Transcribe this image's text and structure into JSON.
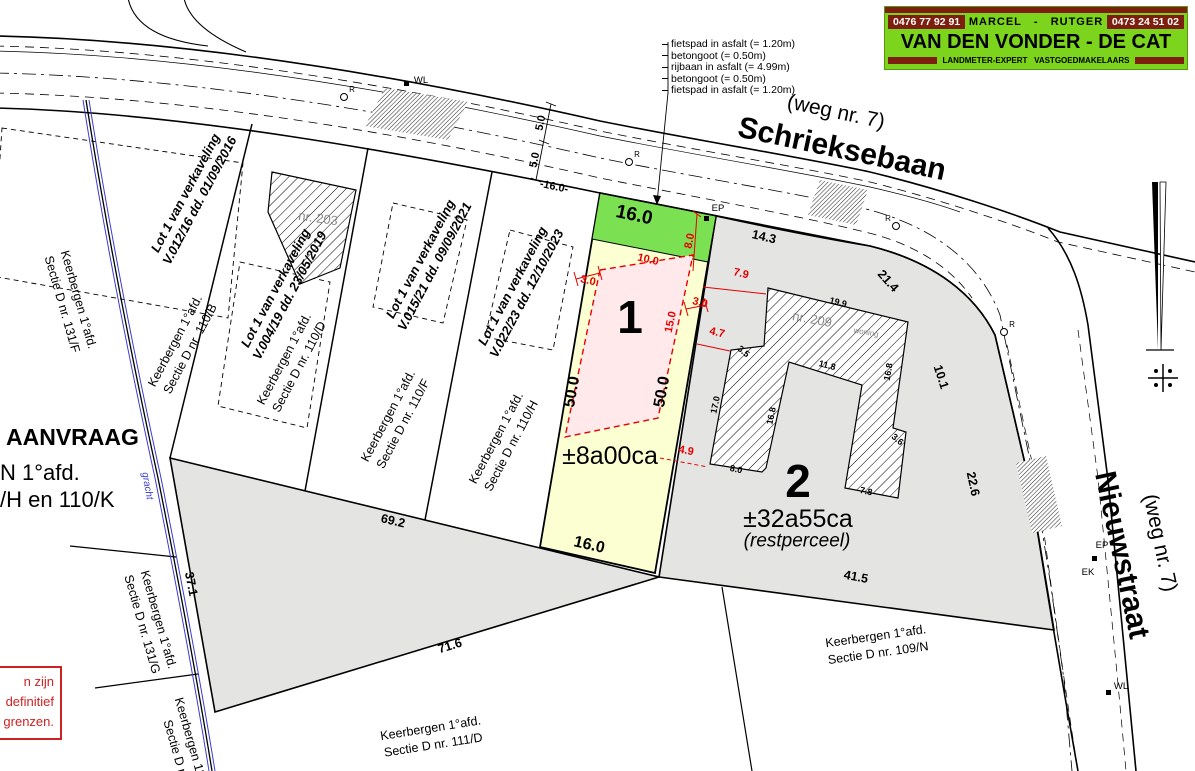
{
  "colors": {
    "background": "#ffffff",
    "parcel_gray": "#e4e4e2",
    "lot1_yellow": "#fcffd2",
    "lot1_green_strip": "#7ce053",
    "lot1_pink_zone": "#ffe9eb",
    "dimension_red": "#e60000",
    "logo_green": "#7cd41d",
    "logo_maroon": "#7d1e0e",
    "gracht_blue": "#3b3bd1",
    "warning_red": "#cc2222"
  },
  "logo": {
    "phone_left": "0476 77 92 91",
    "names": "MARCEL   -   RUTGER",
    "phone_right": "0473 24 51 02",
    "title": "VAN DEN VONDER - DE CAT",
    "subtitle": "LANDMETER-EXPERT   VASTGOEDMAKELAARS"
  },
  "road_legend": {
    "items": [
      "fietspad in asfalt (= 1.20m)",
      "betongoot (= 0.50m)",
      "rijbaan in asfalt (= 4.99m)",
      "betongoot (= 0.50m)",
      "fietspad in asfalt (= 1.20m)"
    ]
  },
  "request_text": {
    "line1": "AANVRAAG",
    "line2": "N 1°afd.",
    "line3": "/H en 110/K"
  },
  "warning_box": {
    "lines": [
      "n zijn",
      "definitief",
      "grenzen."
    ]
  },
  "labels": [
    {
      "n": "street-schrieksebaan-weg",
      "t": "(weg nr. 7)",
      "x": 836,
      "y": 112,
      "r": 12,
      "c": "stsub"
    },
    {
      "n": "street-schrieksebaan",
      "t": "Schrieksebaan",
      "x": 842,
      "y": 149,
      "r": 12,
      "c": "stmain"
    },
    {
      "n": "street-nieuwstraat-weg",
      "t": "(weg nr. 7)",
      "x": 1160,
      "y": 543,
      "r": 78,
      "c": "stsub"
    },
    {
      "n": "street-nieuwstraat",
      "t": "Nieuwstraat",
      "x": 1122,
      "y": 555,
      "r": 78,
      "c": "stmain"
    },
    {
      "n": "lot-v012-16",
      "t": "Lot 1 van verkaveling\nV.012/16 dd. 01/09/2016",
      "x": 193,
      "y": 197,
      "r": -62,
      "c": "lot"
    },
    {
      "n": "lot-v004-19",
      "t": "Lot 1 van verkaveling\nV.004/19 dd. 23/05/2019",
      "x": 283,
      "y": 292,
      "r": -62,
      "c": "lot"
    },
    {
      "n": "lot-v015-21",
      "t": "Lot 1 van verkaveling\nV.015/21 dd. 09/09/2021",
      "x": 428,
      "y": 263,
      "r": -62,
      "c": "lot"
    },
    {
      "n": "lot-v022-23",
      "t": "Lot 1 van verkaveling\nV.022/23 dd. 12/10/2023",
      "x": 520,
      "y": 290,
      "r": -62,
      "c": "lot"
    },
    {
      "n": "kad-131F",
      "t": "Keerbergen 1°afd.\nSectie D nr. 131/F",
      "x": 70,
      "y": 302,
      "r": 74,
      "c": "kad"
    },
    {
      "n": "kad-110B",
      "t": "Keerbergen 1°afd.\nSectie D nr. 110/B",
      "x": 183,
      "y": 345,
      "r": -62,
      "c": "kad"
    },
    {
      "n": "kad-110D",
      "t": "Keerbergen 1°afd.\nSectie D nr. 110/D",
      "x": 292,
      "y": 363,
      "r": -62,
      "c": "kad"
    },
    {
      "n": "kad-110F",
      "t": "Keerbergen 1°afd.\nSectie D nr. 110/F",
      "x": 396,
      "y": 420,
      "r": -62,
      "c": "kad"
    },
    {
      "n": "kad-110H",
      "t": "Keerbergen 1°afd.\nSectie D nr. 110/H",
      "x": 504,
      "y": 442,
      "r": -62,
      "c": "kad"
    },
    {
      "n": "kad-131G",
      "t": "Keerbergen 1°afd.\nSectie D nr. 131/G",
      "x": 150,
      "y": 622,
      "r": 74,
      "c": "kad"
    },
    {
      "n": "kad-bottom-cut",
      "t": "Keerbergen 1°afd.\nSectie D nr.",
      "x": 184,
      "y": 749,
      "r": 74,
      "c": "kad"
    },
    {
      "n": "kad-111D",
      "t": "Keerbergen 1°afd.\nSectie D nr. 111/D",
      "x": 432,
      "y": 737,
      "r": -9,
      "c": "kad"
    },
    {
      "n": "kad-109N",
      "t": "Keerbergen 1°afd.\nSectie D nr. 109/N",
      "x": 877,
      "y": 645,
      "r": -8,
      "c": "kad"
    },
    {
      "n": "parcel1-number",
      "t": "1",
      "x": 630,
      "y": 318,
      "r": 0,
      "c": "big"
    },
    {
      "n": "parcel1-area",
      "t": "±8a00ca",
      "x": 610,
      "y": 456,
      "r": 0,
      "c": "area"
    },
    {
      "n": "parcel2-number",
      "t": "2",
      "x": 798,
      "y": 482,
      "r": 0,
      "c": "big"
    },
    {
      "n": "parcel2-area",
      "t": "±32a55ca",
      "x": 798,
      "y": 519,
      "r": 0,
      "c": "area"
    },
    {
      "n": "parcel2-note",
      "t": "(restperceel)",
      "x": 797,
      "y": 542,
      "r": 0,
      "c": "rest"
    },
    {
      "n": "house-nr203",
      "t": "nr. 203",
      "x": 318,
      "y": 219,
      "r": 8,
      "c": "house"
    },
    {
      "n": "house-nr209",
      "t": "nr. 209",
      "x": 812,
      "y": 320,
      "r": 10,
      "c": "house"
    },
    {
      "n": "house-woning",
      "t": "woning",
      "x": 866,
      "y": 333,
      "r": 10,
      "c": "housesm"
    },
    {
      "n": "dim-front-16",
      "t": "16.0",
      "x": 634,
      "y": 216,
      "r": 12,
      "c": "dimbig"
    },
    {
      "n": "dim-left-50",
      "t": "50.0",
      "x": 573,
      "y": 392,
      "r": -80,
      "c": "dimmed"
    },
    {
      "n": "dim-right-50",
      "t": "50.0",
      "x": 663,
      "y": 392,
      "r": -80,
      "c": "dimmed"
    },
    {
      "n": "dim-bottom-16",
      "t": "16.0",
      "x": 589,
      "y": 546,
      "r": 13,
      "c": "dimmed"
    },
    {
      "n": "dim-road-16",
      "t": "-16.0-",
      "x": 554,
      "y": 187,
      "r": 12,
      "c": "dim"
    },
    {
      "n": "dim-road-5a",
      "t": "5.0",
      "x": 541,
      "y": 123,
      "r": -78,
      "c": "dim"
    },
    {
      "n": "dim-road-5b",
      "t": "5.0",
      "x": 535,
      "y": 160,
      "r": -78,
      "c": "dim"
    },
    {
      "n": "dim-14-3",
      "t": "14.3",
      "x": 764,
      "y": 237,
      "r": 13,
      "c": "dimb"
    },
    {
      "n": "dim-21-4",
      "t": "21.4",
      "x": 888,
      "y": 281,
      "r": 48,
      "c": "dimb"
    },
    {
      "n": "dim-10-1",
      "t": "10.1",
      "x": 941,
      "y": 377,
      "r": 72,
      "c": "dimb"
    },
    {
      "n": "dim-22-6",
      "t": "22.6",
      "x": 973,
      "y": 484,
      "r": 78,
      "c": "dimb"
    },
    {
      "n": "dim-41-5",
      "t": "41.5",
      "x": 856,
      "y": 577,
      "r": 11,
      "c": "dimb"
    },
    {
      "n": "dim-69-2",
      "t": "69.2",
      "x": 393,
      "y": 521,
      "r": 13,
      "c": "dimb"
    },
    {
      "n": "dim-71-6",
      "t": "71.6",
      "x": 450,
      "y": 646,
      "r": -17,
      "c": "dimb"
    },
    {
      "n": "dim-37-1",
      "t": "37.1",
      "x": 191,
      "y": 584,
      "r": 79,
      "c": "dimb"
    },
    {
      "n": "bdim-19-9",
      "t": "19.9",
      "x": 838,
      "y": 303,
      "r": 14,
      "c": "dimsm"
    },
    {
      "n": "bdim-3-5",
      "t": "3.5",
      "x": 743,
      "y": 352,
      "r": 40,
      "c": "dimsm"
    },
    {
      "n": "bdim-17-0",
      "t": "17.0",
      "x": 716,
      "y": 405,
      "r": -78,
      "c": "dimsm"
    },
    {
      "n": "bdim-16-8a",
      "t": "16.8",
      "x": 772,
      "y": 416,
      "r": -78,
      "c": "dimsm"
    },
    {
      "n": "bdim-11-8",
      "t": "11.8",
      "x": 827,
      "y": 366,
      "r": 14,
      "c": "dimsm"
    },
    {
      "n": "bdim-16-8b",
      "t": "16.8",
      "x": 889,
      "y": 372,
      "r": -80,
      "c": "dimsm"
    },
    {
      "n": "bdim-3-6",
      "t": "3.6",
      "x": 897,
      "y": 440,
      "r": 40,
      "c": "dimsm"
    },
    {
      "n": "bdim-8-0",
      "t": "8.0",
      "x": 736,
      "y": 470,
      "r": 12,
      "c": "dimsm"
    },
    {
      "n": "bdim-7-8",
      "t": "7.8",
      "x": 866,
      "y": 492,
      "r": 12,
      "c": "dimsm"
    },
    {
      "n": "rdim-3-0-left",
      "t": "3.0",
      "x": 588,
      "y": 281,
      "r": 13,
      "c": "red"
    },
    {
      "n": "rdim-10-0",
      "t": "10.0",
      "x": 648,
      "y": 260,
      "r": 13,
      "c": "red"
    },
    {
      "n": "rdim-8-0",
      "t": "8.0",
      "x": 690,
      "y": 241,
      "r": -78,
      "c": "red"
    },
    {
      "n": "rdim-3-0-right",
      "t": "3.0",
      "x": 700,
      "y": 303,
      "r": 13,
      "c": "red"
    },
    {
      "n": "rdim-15-0",
      "t": "15.0",
      "x": 671,
      "y": 322,
      "r": -78,
      "c": "red"
    },
    {
      "n": "rdim-7-9",
      "t": "7.9",
      "x": 741,
      "y": 274,
      "r": 13,
      "c": "red"
    },
    {
      "n": "rdim-4-7",
      "t": "4.7",
      "x": 717,
      "y": 333,
      "r": 13,
      "c": "red"
    },
    {
      "n": "rdim-4-9",
      "t": "4.9",
      "x": 686,
      "y": 451,
      "r": 11,
      "c": "red"
    },
    {
      "n": "marker-WL-top",
      "t": "WL",
      "x": 421,
      "y": 81,
      "r": 0,
      "c": "mk"
    },
    {
      "n": "marker-EP-lot1",
      "t": "EP",
      "x": 718,
      "y": 209,
      "r": 0,
      "c": "mk"
    },
    {
      "n": "marker-EP-nieuwstraat",
      "t": "EP",
      "x": 1102,
      "y": 546,
      "r": 0,
      "c": "mk"
    },
    {
      "n": "marker-EK-nieuwstraat",
      "t": "EK",
      "x": 1088,
      "y": 573,
      "r": 0,
      "c": "mk"
    },
    {
      "n": "marker-WL-bottom",
      "t": "WL",
      "x": 1121,
      "y": 687,
      "r": 0,
      "c": "mk"
    },
    {
      "n": "marker-R-1",
      "t": "R",
      "x": 352,
      "y": 90,
      "r": 0,
      "c": "rsup"
    },
    {
      "n": "marker-R-2",
      "t": "R",
      "x": 637,
      "y": 155,
      "r": 0,
      "c": "rsup"
    },
    {
      "n": "marker-R-3",
      "t": "R",
      "x": 1012,
      "y": 325,
      "r": 0,
      "c": "rsup"
    },
    {
      "n": "marker-R-4",
      "t": "R",
      "x": 888,
      "y": 219,
      "r": 0,
      "c": "rsup"
    },
    {
      "n": "gracht-label",
      "t": "gracht",
      "x": 147,
      "y": 486,
      "r": 80,
      "c": "gracht"
    }
  ]
}
